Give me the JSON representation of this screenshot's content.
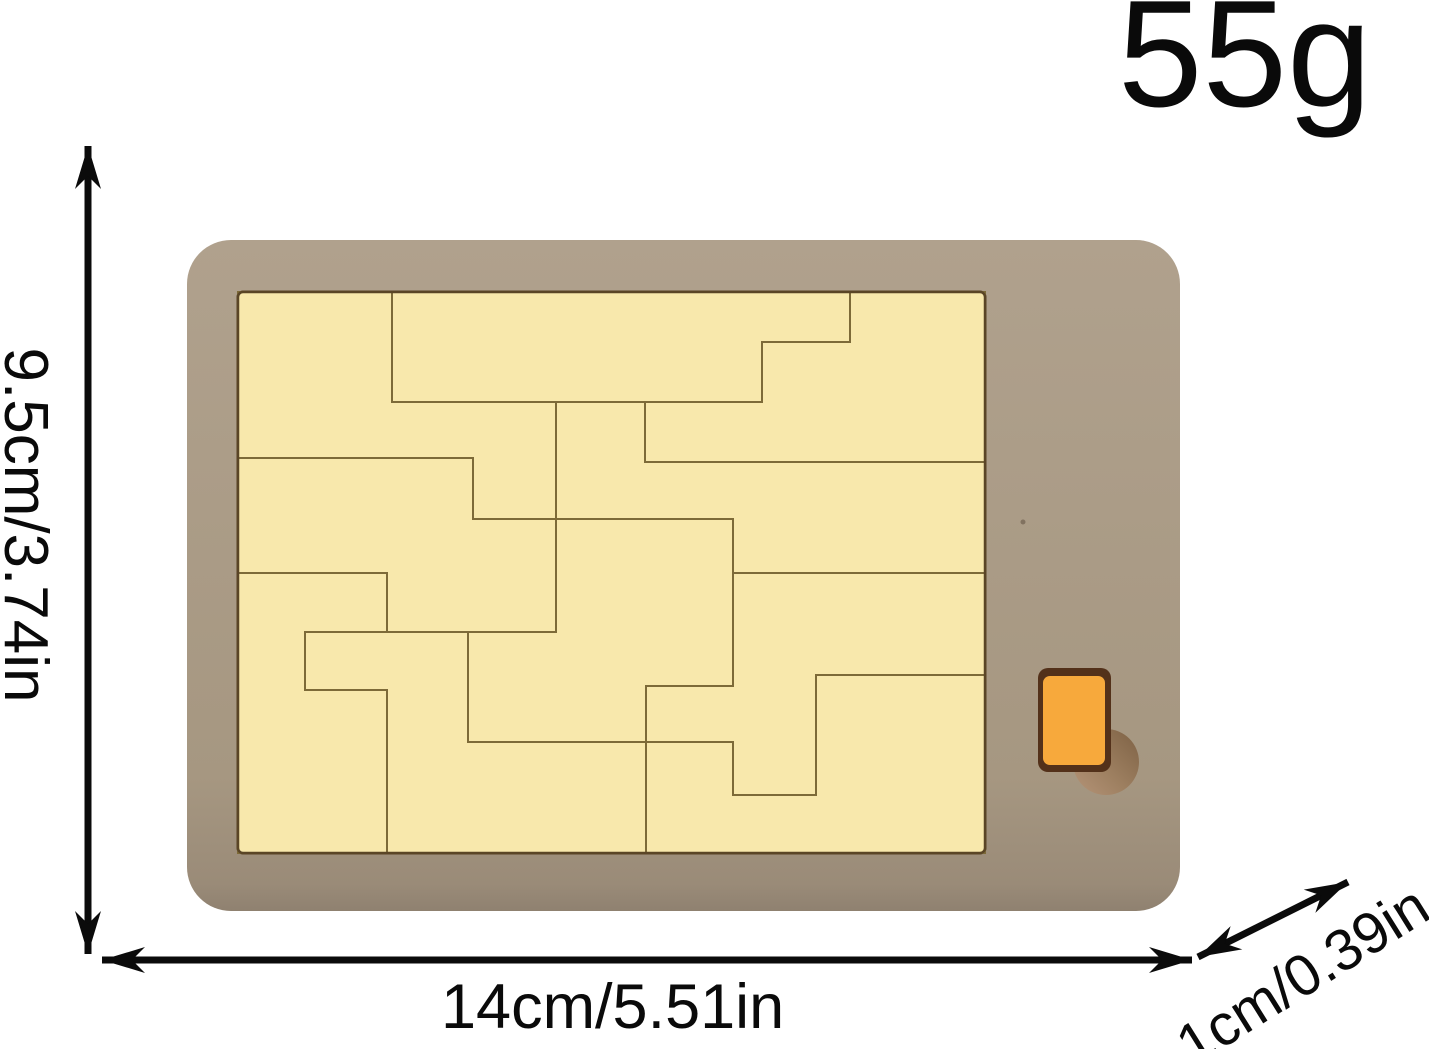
{
  "product": {
    "weight": "55g",
    "height_label": "9.5cm/3.74in",
    "width_label": "14cm/5.51in",
    "thickness_label": "1cm/0.39in"
  },
  "colors": {
    "background": "#ffffff",
    "board_tan": "#a79983",
    "board_edge_dark": "#8f8170",
    "tray_fill": "#f8e8ac",
    "tray_border": "#5a4526",
    "piece_fill": "#f8e8ac",
    "piece_seam": "#7d6a38",
    "knob_orange": "#f7a93c",
    "knob_rim": "#53311a",
    "hole_dark": "#7d6144",
    "hole_light": "#b59478",
    "dimension_ink": "#0b0b0b"
  },
  "puzzle": {
    "board": {
      "x": 187,
      "y": 240,
      "w": 993,
      "h": 671,
      "rx": 44
    },
    "tray": {
      "x": 238,
      "y": 292,
      "w": 747,
      "h": 561,
      "rx": 5
    },
    "knob_rim": {
      "x": 1038,
      "y": 668,
      "w": 73,
      "h": 104,
      "rx": 10
    },
    "knob": {
      "x": 1043,
      "y": 676,
      "w": 62,
      "h": 89,
      "rx": 7
    },
    "hole": {
      "cx": 1106,
      "cy": 762,
      "r": 33
    },
    "speck": {
      "cx": 1023,
      "cy": 522,
      "r": 2.5
    },
    "pieces": [
      {
        "id": "top-left-step",
        "points": [
          [
            238,
            292
          ],
          [
            392,
            292
          ],
          [
            392,
            402
          ],
          [
            556,
            402
          ],
          [
            556,
            519
          ],
          [
            473,
            519
          ],
          [
            473,
            458
          ],
          [
            238,
            458
          ]
        ]
      },
      {
        "id": "top-bar",
        "points": [
          [
            392,
            292
          ],
          [
            850,
            292
          ],
          [
            850,
            342
          ],
          [
            762,
            342
          ],
          [
            762,
            402
          ],
          [
            392,
            402
          ]
        ]
      },
      {
        "id": "top-right-corner",
        "points": [
          [
            850,
            292
          ],
          [
            985,
            292
          ],
          [
            985,
            462
          ],
          [
            645,
            462
          ],
          [
            645,
            402
          ],
          [
            762,
            402
          ],
          [
            762,
            342
          ],
          [
            850,
            342
          ]
        ]
      },
      {
        "id": "right-middle-s",
        "points": [
          [
            556,
            402
          ],
          [
            645,
            402
          ],
          [
            645,
            462
          ],
          [
            985,
            462
          ],
          [
            985,
            573
          ],
          [
            733,
            573
          ],
          [
            733,
            519
          ],
          [
            556,
            519
          ]
        ]
      },
      {
        "id": "middle-left-z",
        "points": [
          [
            238,
            458
          ],
          [
            473,
            458
          ],
          [
            473,
            519
          ],
          [
            556,
            519
          ],
          [
            556,
            632
          ],
          [
            387,
            632
          ],
          [
            387,
            573
          ],
          [
            238,
            573
          ]
        ]
      },
      {
        "id": "bottom-left-c",
        "points": [
          [
            238,
            573
          ],
          [
            387,
            573
          ],
          [
            387,
            632
          ],
          [
            305,
            632
          ],
          [
            305,
            690
          ],
          [
            387,
            690
          ],
          [
            387,
            853
          ],
          [
            238,
            853
          ]
        ]
      },
      {
        "id": "bottom-middle-step",
        "points": [
          [
            305,
            632
          ],
          [
            468,
            632
          ],
          [
            468,
            742
          ],
          [
            646,
            742
          ],
          [
            646,
            853
          ],
          [
            387,
            853
          ],
          [
            387,
            690
          ],
          [
            305,
            690
          ]
        ]
      },
      {
        "id": "center-s",
        "points": [
          [
            556,
            519
          ],
          [
            733,
            519
          ],
          [
            733,
            686
          ],
          [
            646,
            686
          ],
          [
            646,
            742
          ],
          [
            468,
            742
          ],
          [
            468,
            632
          ],
          [
            556,
            632
          ]
        ]
      },
      {
        "id": "lower-right-pocket",
        "points": [
          [
            733,
            573
          ],
          [
            985,
            573
          ],
          [
            985,
            675
          ],
          [
            816,
            675
          ],
          [
            816,
            795
          ],
          [
            733,
            795
          ],
          [
            733,
            742
          ],
          [
            646,
            742
          ],
          [
            646,
            686
          ],
          [
            733,
            686
          ]
        ]
      },
      {
        "id": "bottom-right-corner",
        "points": [
          [
            646,
            742
          ],
          [
            733,
            742
          ],
          [
            733,
            795
          ],
          [
            816,
            795
          ],
          [
            816,
            675
          ],
          [
            985,
            675
          ],
          [
            985,
            853
          ],
          [
            646,
            853
          ]
        ]
      }
    ]
  }
}
